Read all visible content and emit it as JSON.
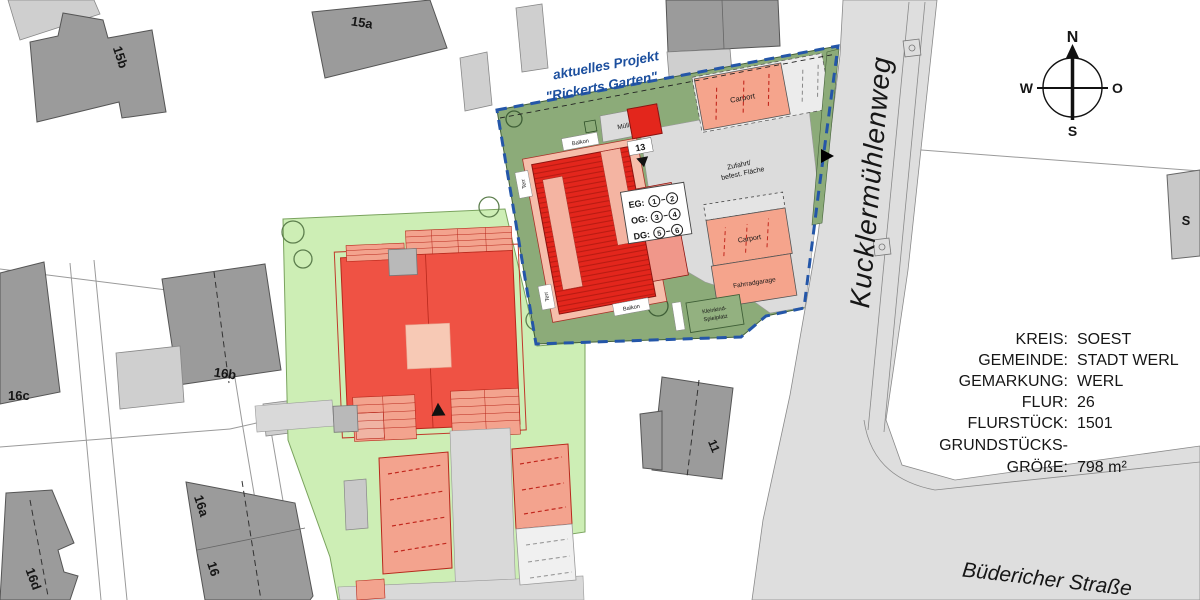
{
  "map": {
    "project_label": {
      "line1": "aktuelles Projekt",
      "line2": "\"Rickerts Garten\""
    },
    "streets": {
      "kuckler": "Kucklermühlenweg",
      "buedericher": "Büdericher Straße"
    },
    "compass": {
      "north": "N",
      "east": "O",
      "south": "S",
      "west": "W"
    },
    "buildings": {
      "b15a": "15a",
      "b15b": "15b",
      "b16": "16",
      "b16a": "16a",
      "b16b": "16b",
      "b16c": "16c",
      "b16d": "16d",
      "b11": "11",
      "bS": "S",
      "new_building_number": "13"
    },
    "site": {
      "muellplatz": "Müllplatz",
      "carport_top": "Carport",
      "carport_right": "Carport",
      "fahrradgarage": "Fahrradgarage",
      "zufahrt_line1": "Zufahrt/",
      "zufahrt_line2": "befest. Fläche",
      "spielplatz_line1": "Kleinkind-",
      "spielplatz_line2": "Spielplatz",
      "balkon_top": "Balkon",
      "balkon_bottom": "Balkon",
      "terrace_upper": "Terr",
      "terrace_lower": "Terr"
    },
    "floor_annotation": {
      "rows": [
        {
          "label": "EG:",
          "from": "1",
          "to": "2"
        },
        {
          "label": "OG:",
          "from": "3",
          "to": "4"
        },
        {
          "label": "DG:",
          "from": "5",
          "to": "6"
        }
      ]
    },
    "info_panel": {
      "rows": [
        {
          "label": "KREIS:",
          "value": "SOEST"
        },
        {
          "label": "GEMEINDE:",
          "value": "STADT WERL"
        },
        {
          "label": "GEMARKUNG:",
          "value": "WERL"
        },
        {
          "label": "FLUR:",
          "value": "26"
        },
        {
          "label": "FLURSTÜCK:",
          "value": "1501"
        },
        {
          "label": "GRUNDSTÜCKS-",
          "value": ""
        },
        {
          "label": "GRÖßE:",
          "value": "798 m²"
        }
      ]
    },
    "colors": {
      "site_boundary_blue": "#2456a8",
      "project_text_blue": "#1c4f9e",
      "new_building_red": "#e3261c",
      "existing_building_red": "#ef5244",
      "carport_salmon": "#f5a48c",
      "garden_green": "#8cab79",
      "lawn_light_green": "#cdeeb5",
      "building_gray": "#9b9b9b",
      "street_gray": "#dedede"
    }
  }
}
